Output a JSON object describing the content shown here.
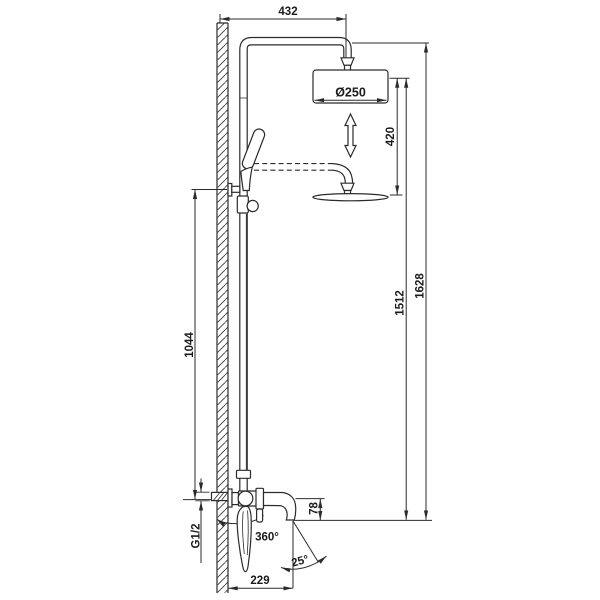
{
  "page": {
    "background": "#ffffff",
    "line_color": "#2b2b2b"
  },
  "drawing": {
    "kind": "technical-dimension-drawing",
    "subject": "wall-mounted shower column with overhead rain shower, hand shower and swivel tub spout",
    "labels": {
      "top_width": "432",
      "head_diameter": "Ø250",
      "adjust_range": "420",
      "head_height": "1512",
      "total_height": "1628",
      "bracket_height": "1044",
      "spout_height": "78",
      "inlet_thread": "G1/2",
      "swivel_angle": "360°",
      "spray_angle": "25°",
      "spout_reach": "229"
    }
  }
}
